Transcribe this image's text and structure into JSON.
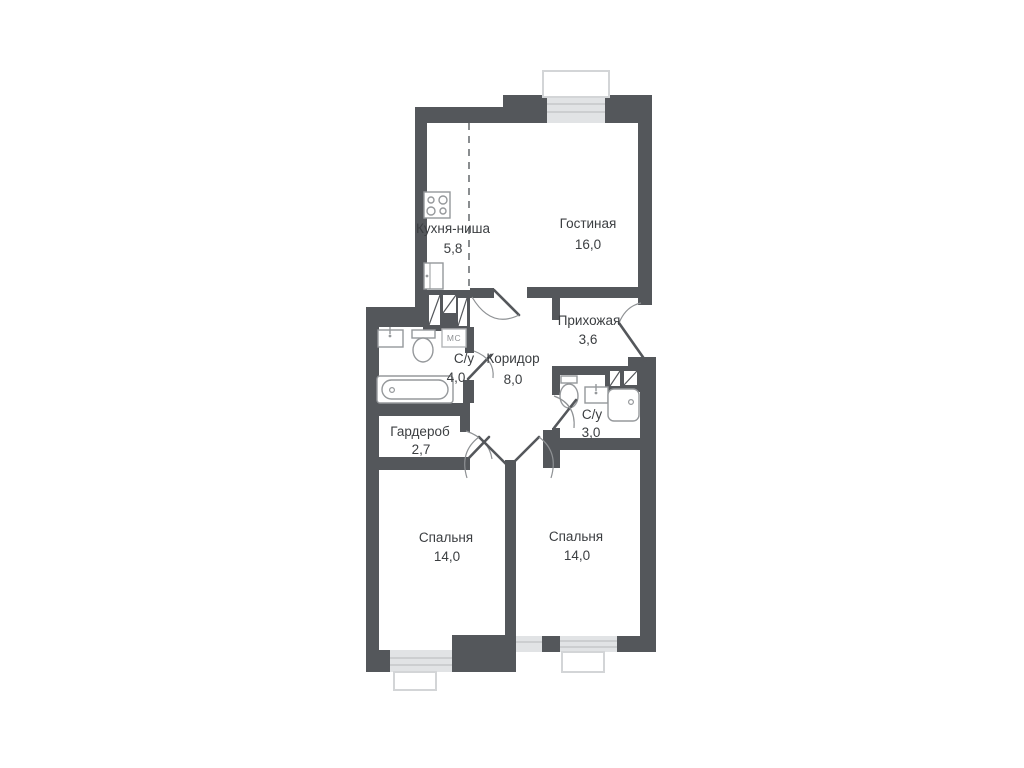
{
  "plan": {
    "title": "apartment-floor-plan",
    "rooms": {
      "kitchen": {
        "name": "Кухня-ниша",
        "area": "5,8"
      },
      "living": {
        "name": "Гостиная",
        "area": "16,0"
      },
      "hallway": {
        "name": "Прихожая",
        "area": "3,6"
      },
      "corridor": {
        "name": "Коридор",
        "area": "8,0"
      },
      "bathroom_big": {
        "name": "С/у",
        "area": "4,0"
      },
      "wardrobe": {
        "name": "Гардероб",
        "area": "2,7"
      },
      "bathroom_small": {
        "name": "С/у",
        "area": "3,0"
      },
      "bedroom_left": {
        "name": "Спальня",
        "area": "14,0"
      },
      "bedroom_right": {
        "name": "Спальня",
        "area": "14,0"
      }
    },
    "labels": {
      "washing_machine": "МС"
    },
    "colors": {
      "wall": "#54575b",
      "window_fill": "#e1e3e5",
      "balcony_outline": "#d3d5d7",
      "fixture_outline": "#95989b",
      "text": "#3b3e41"
    }
  }
}
